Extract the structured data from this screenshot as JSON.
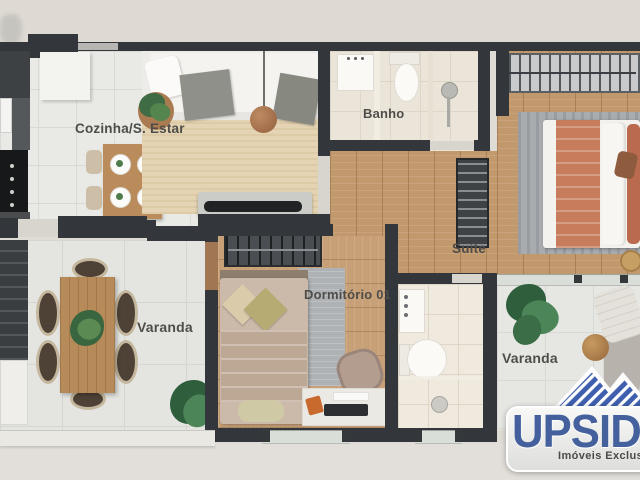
{
  "plan_labels": {
    "kitchen_living": "Cozinha/S. Estar",
    "bathroom": "Banho",
    "suite": "Suíte",
    "bedroom_01": "Dormitório 01",
    "balcony_left": "Varanda",
    "balcony_right": "Varanda"
  },
  "logo": {
    "brand": "UPSIDE",
    "tagline": "Imóveis Exclusivos"
  },
  "colors": {
    "background": "#DFDBD4",
    "wall": "#33363A",
    "wood_floor": "#C2996C",
    "tile_floor": "#E9E9E5",
    "living_rug": "#E5D4B4",
    "suite_blanket_salmon": "#C77C5C",
    "logo_blue": "#44619E"
  }
}
